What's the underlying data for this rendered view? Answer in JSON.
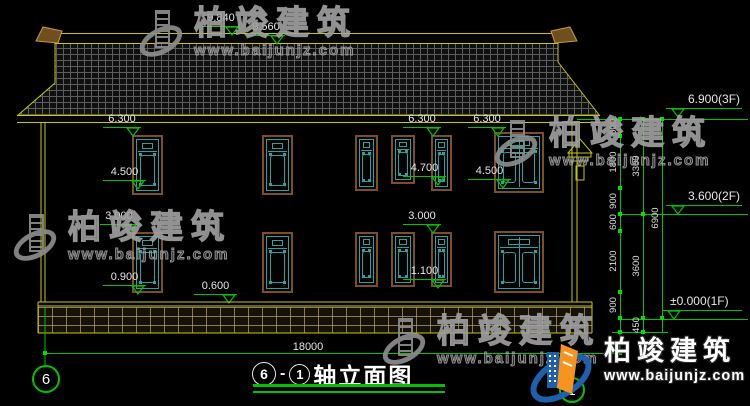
{
  "colors": {
    "background": "#000000",
    "line_yellow": "#c9c900",
    "dim_green": "#00c400",
    "dim_text": "#e6e6e6",
    "window_teal": "#2fa0a0",
    "frame_brown": "#7e4e2a",
    "watermark_gray": "#8f8f8f",
    "logo_blue": "#1e5fae",
    "logo_orange": "#f7941d"
  },
  "watermark": {
    "name": "柏竣建筑",
    "url": "www.baijunjz.com"
  },
  "watermarks_positions": [
    {
      "x": 138,
      "y": 6
    },
    {
      "x": 12,
      "y": 210
    },
    {
      "x": 493,
      "y": 116
    },
    {
      "x": 381,
      "y": 314
    }
  ],
  "logo": {
    "name": "柏竣建筑",
    "url": "www.baijunjz.com"
  },
  "title_block": {
    "axis_from": "6",
    "dash": "-",
    "axis_to": "1",
    "title": "轴立面图"
  },
  "axis_bubbles": {
    "left": "6",
    "right": "1"
  },
  "facade_markers": [
    {
      "t": "9.840",
      "x1": 202,
      "x2": 240,
      "y": 26,
      "tri": "right"
    },
    {
      "t": "9.560",
      "x1": 247,
      "x2": 285,
      "y": 35,
      "tri": "right"
    },
    {
      "t": "6.300",
      "x1": 103,
      "x2": 141,
      "y": 127,
      "tri": "right"
    },
    {
      "t": "6.300",
      "x1": 403,
      "x2": 441,
      "y": 127,
      "tri": "right"
    },
    {
      "t": "6.300",
      "x1": 468,
      "x2": 506,
      "y": 127,
      "tri": "right"
    },
    {
      "t": "4.500",
      "x1": 103,
      "x2": 146,
      "y": 180,
      "tri": "right"
    },
    {
      "t": "4.700",
      "x1": 403,
      "x2": 446,
      "y": 176,
      "tri": "right"
    },
    {
      "t": "4.500",
      "x1": 468,
      "x2": 511,
      "y": 179,
      "tri": "right"
    },
    {
      "t": "3.000",
      "x1": 100,
      "x2": 138,
      "y": 224,
      "tri": "right"
    },
    {
      "t": "3.000",
      "x1": 403,
      "x2": 441,
      "y": 224,
      "tri": "right"
    },
    {
      "t": "0.900",
      "x1": 103,
      "x2": 146,
      "y": 285,
      "tri": "right"
    },
    {
      "t": "1.100",
      "x1": 403,
      "x2": 446,
      "y": 279,
      "tri": "right"
    },
    {
      "t": "0.600",
      "x1": 194,
      "x2": 237,
      "y": 294,
      "tri": "right"
    }
  ],
  "level_markers": [
    {
      "t": "6.900(3F)",
      "x1": 666,
      "x2": 742,
      "y": 108,
      "tx": 688,
      "ty": 93,
      "tri": "left"
    },
    {
      "t": "3.600(2F)",
      "x1": 666,
      "x2": 742,
      "y": 205,
      "tx": 688,
      "ty": 190,
      "tri": "left"
    },
    {
      "t": "±0.000(1F)",
      "x1": 662,
      "x2": 742,
      "y": 310,
      "tx": 670,
      "ty": 295,
      "tri": "left"
    }
  ],
  "level_lines": [
    {
      "x1": 577,
      "x2": 748,
      "y": 119
    },
    {
      "x1": 618,
      "x2": 748,
      "y": 214
    },
    {
      "x1": 618,
      "x2": 748,
      "y": 319
    },
    {
      "x1": 612,
      "x2": 668,
      "y": 332
    }
  ],
  "chains": [
    {
      "x": 620,
      "y1": 119,
      "y2": 332,
      "ticks": [
        119,
        136,
        188,
        214,
        231,
        292,
        318,
        332
      ],
      "labels": [
        {
          "t": "600",
          "y": 127
        },
        {
          "t": "1800",
          "y": 162
        },
        {
          "t": "900",
          "y": 201
        },
        {
          "t": "600",
          "y": 222
        },
        {
          "t": "2100",
          "y": 261
        },
        {
          "t": "900",
          "y": 305
        }
      ]
    },
    {
      "x": 643,
      "y1": 119,
      "y2": 332,
      "ticks": [
        119,
        214,
        318,
        332
      ],
      "labels": [
        {
          "t": "3300",
          "y": 166
        },
        {
          "t": "3600",
          "y": 266
        },
        {
          "t": "450",
          "y": 325
        }
      ]
    },
    {
      "x": 662,
      "y1": 119,
      "y2": 332,
      "ticks": [
        119,
        318
      ],
      "labels": [
        {
          "t": "6900",
          "y": 218
        }
      ]
    }
  ],
  "width_dim": {
    "t": "18000",
    "x1": 45,
    "x2": 620,
    "y": 353,
    "lx": 308,
    "ly": 341
  },
  "windows": [
    {
      "x": 132,
      "y": 135,
      "w": 31,
      "h": 60,
      "wide": false
    },
    {
      "x": 262,
      "y": 135,
      "w": 31,
      "h": 60,
      "wide": false
    },
    {
      "x": 355,
      "y": 135,
      "w": 23,
      "h": 56,
      "wide": false
    },
    {
      "x": 391,
      "y": 135,
      "w": 24,
      "h": 49,
      "wide": false
    },
    {
      "x": 431,
      "y": 135,
      "w": 21,
      "h": 56,
      "wide": false
    },
    {
      "x": 494,
      "y": 132,
      "w": 50,
      "h": 61,
      "wide": true
    },
    {
      "x": 132,
      "y": 232,
      "w": 31,
      "h": 61,
      "wide": false
    },
    {
      "x": 262,
      "y": 232,
      "w": 31,
      "h": 61,
      "wide": false
    },
    {
      "x": 355,
      "y": 232,
      "w": 23,
      "h": 55,
      "wide": false
    },
    {
      "x": 391,
      "y": 232,
      "w": 24,
      "h": 55,
      "wide": false
    },
    {
      "x": 431,
      "y": 232,
      "w": 21,
      "h": 55,
      "wide": false
    },
    {
      "x": 494,
      "y": 231,
      "w": 50,
      "h": 62,
      "wide": true
    }
  ]
}
